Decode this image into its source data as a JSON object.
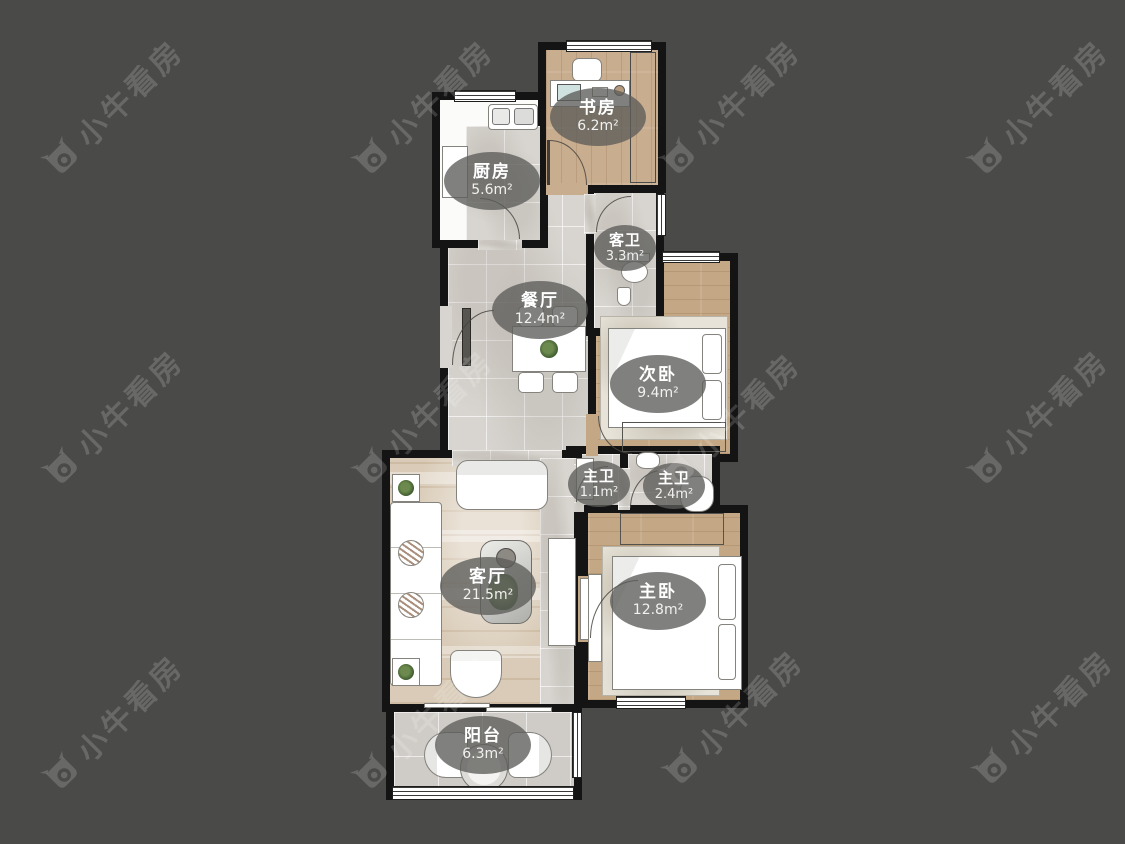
{
  "watermark": {
    "text": "小牛看房"
  },
  "rooms": [
    {
      "id": "study",
      "name": "书房",
      "area": "6.2m²"
    },
    {
      "id": "kitchen",
      "name": "厨房",
      "area": "5.6m²"
    },
    {
      "id": "guest_bathroom",
      "name": "客卫",
      "area": "3.3m²"
    },
    {
      "id": "dining_room",
      "name": "餐厅",
      "area": "12.4m²"
    },
    {
      "id": "second_bedroom",
      "name": "次卧",
      "area": "9.4m²"
    },
    {
      "id": "master_bath_inner",
      "name": "主卫",
      "area": "1.1m²"
    },
    {
      "id": "master_bathroom",
      "name": "主卫",
      "area": "2.4m²"
    },
    {
      "id": "living_room",
      "name": "客厅",
      "area": "21.5m²"
    },
    {
      "id": "master_bedroom",
      "name": "主卧",
      "area": "12.8m²"
    },
    {
      "id": "balcony",
      "name": "阳台",
      "area": "6.3m²"
    }
  ],
  "colors": {
    "background": "#4a4a48",
    "wall": "#141414",
    "wood_floor": "#c8ad8e",
    "tile_floor": "#d8d5d0",
    "label_background": "rgba(92,92,90,0.78)",
    "watermark_gray": "#6e6e6c",
    "plant_green": "#4a6b3a"
  }
}
